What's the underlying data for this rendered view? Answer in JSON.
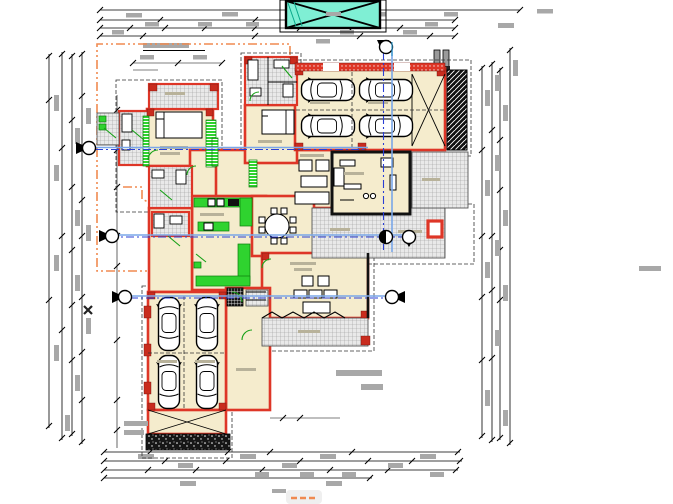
{
  "drawing": {
    "type": "architectural-floor-plan",
    "description": "CAD ground-floor plan of a residence with two garages, pool/skylight at top, dimension strings on all four sides, roof-overhang dash-dot outline and blue section lines",
    "legible_text": false,
    "text_note": "all dimension and label text renders as illegible gray blobs at this scale"
  },
  "palette": {
    "floor_cream": "#f5eccd",
    "wall_red": "#de3627",
    "wall_red_dark": "#c92c1e",
    "tile_gray": "#e9e9e9",
    "tile_line": "#9a9a9a",
    "accent_green": "#2fd32f",
    "pool_cyan": "#7fefd4",
    "dim_gray": "#a8a8a8",
    "roof_orange": "#f08a50",
    "section_blue_dash": "#2b3fd4",
    "section_blue_solid": "#7aa7e8",
    "furn_gray": "#b8b29a",
    "line_black": "#000000"
  },
  "counts": {
    "cars_upper_garage": 4,
    "cars_lower_garage": 4,
    "section_markers": 7,
    "top_dimension_rows": 4,
    "bottom_dimension_rows": 4,
    "left_dimension_columns": 4,
    "right_dimension_columns": 4
  },
  "section_lines": [
    {
      "name": "section-A",
      "orientation": "horizontal",
      "y": 148
    },
    {
      "name": "section-B",
      "orientation": "horizontal",
      "y": 236
    },
    {
      "name": "section-C",
      "orientation": "horizontal",
      "y": 297
    },
    {
      "name": "section-D",
      "orientation": "vertical",
      "x": 388
    }
  ],
  "legend_chip": {
    "style": "orange-dashed-line-sample"
  }
}
